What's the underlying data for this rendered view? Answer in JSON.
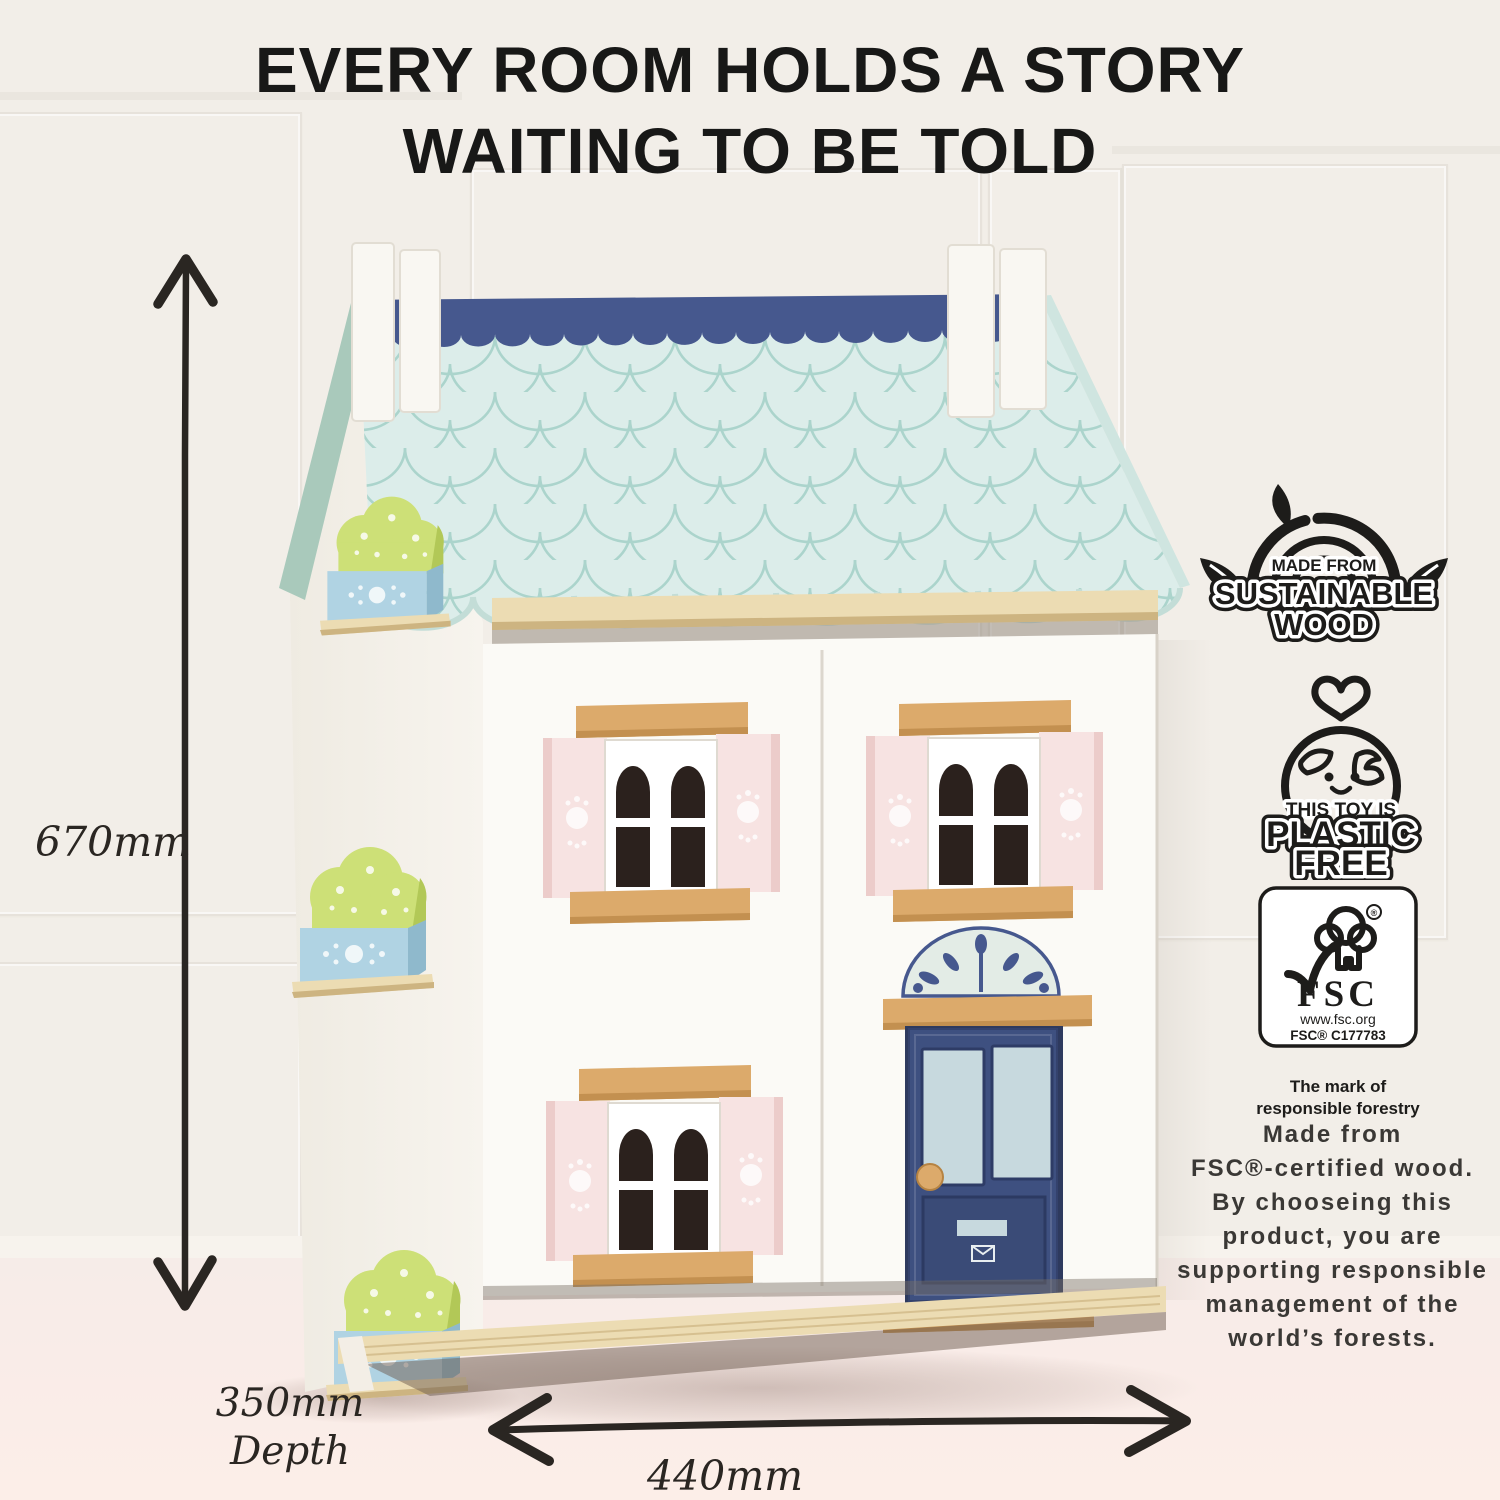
{
  "title": {
    "line1": "EVERY ROOM HOLDS A STORY",
    "line2": "WAITING TO BE TOLD"
  },
  "dimensions": {
    "height": "670mm",
    "depth_value": "350mm",
    "depth_label": "Depth",
    "width": "440mm"
  },
  "badges": {
    "sustainable_wood": {
      "small": "MADE FROM",
      "big1": "SUSTAINABLE",
      "big2": "WOOD"
    },
    "plastic_free": {
      "small": "THIS TOY IS",
      "big1": "PLASTIC",
      "big2": "FREE"
    },
    "fsc": {
      "acronym": "FSC",
      "registered": "®",
      "url": "www.fsc.org",
      "license": "FSC® C177783",
      "tagline1": "The mark of",
      "tagline2": "responsible forestry"
    }
  },
  "description": {
    "lines": [
      "Made from",
      "FSC®-certified wood.",
      "By chooseing this",
      "product, you are",
      "supporting responsible",
      "management of the",
      "world’s forests."
    ]
  },
  "colors": {
    "c-wall": "#f2eee8",
    "c-floor": "#f9ece8",
    "c-roof": "#dcedea",
    "c-roof-line": "#abd4cc",
    "c-navy": "#46588e",
    "c-door-navy": "#3e5080",
    "c-sage": "#a9c9bb",
    "c-wood": "#dcaa6b",
    "c-wood-dark": "#c39050",
    "c-plywood": "#ecdcb3",
    "c-plywood-line": "#cdb481",
    "c-pink": "#f7e3e2",
    "c-pink-dark": "#ecccca",
    "c-pane": "#2b211d",
    "c-glass": "#c7d9de",
    "c-green": "#cde077",
    "c-green-dark": "#b2c857",
    "c-box-blue": "#b0d3e3",
    "c-box-blue-dark": "#8fb9cc",
    "c-house-white": "#fbfaf6",
    "c-dim": "#2a2622",
    "c-text": "#3a3835",
    "c-ink": "#1d1c1a"
  }
}
